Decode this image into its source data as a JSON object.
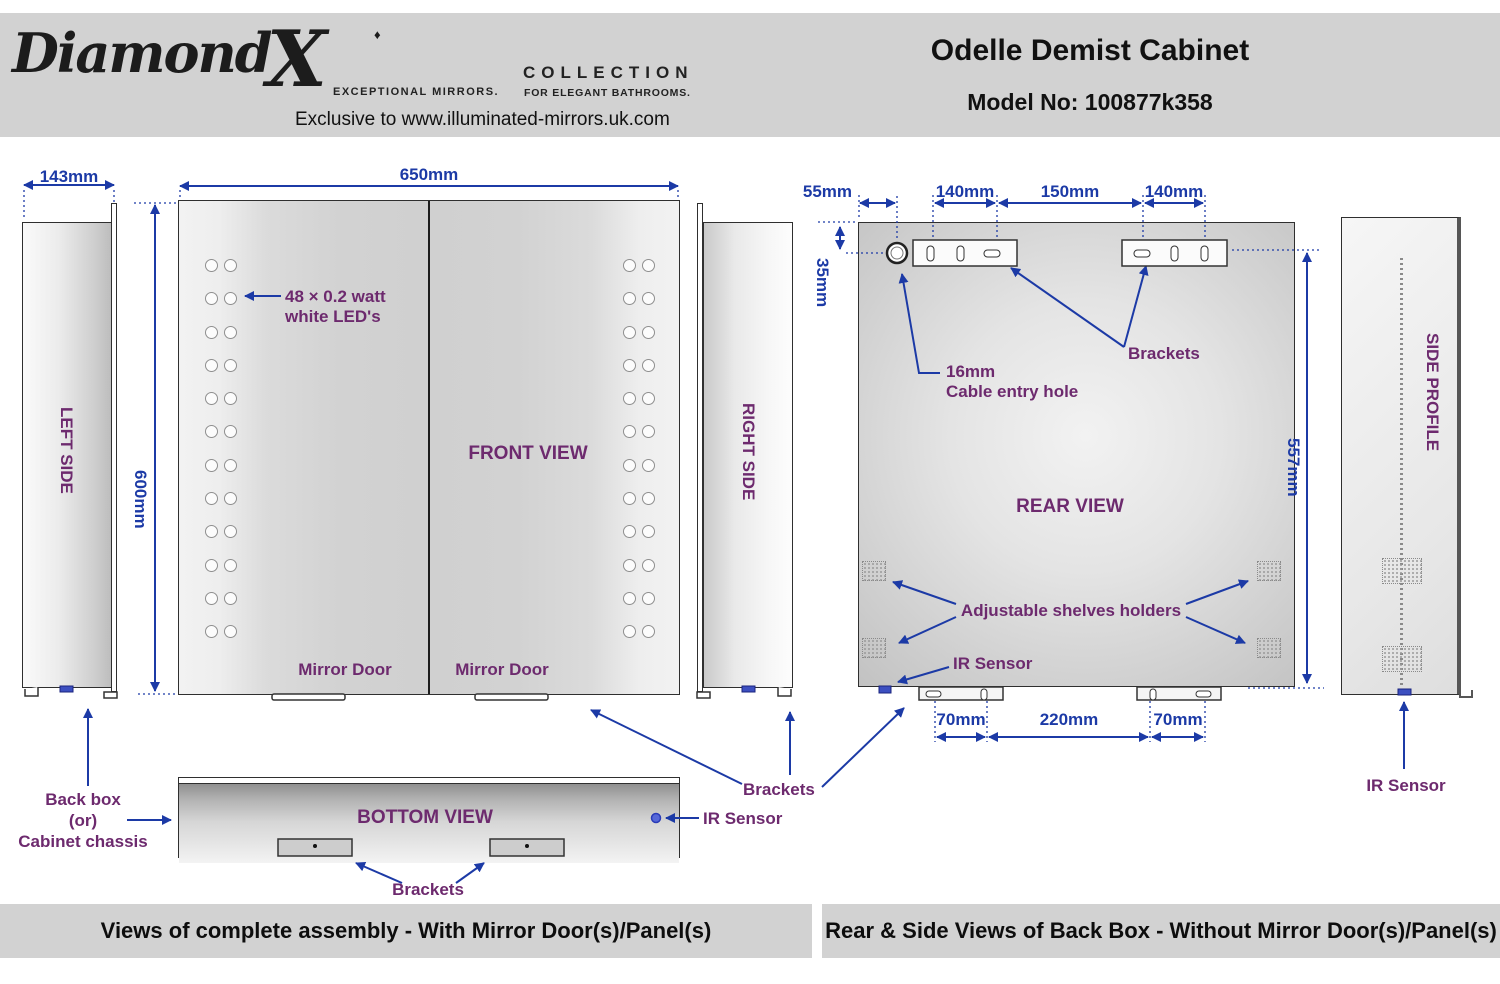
{
  "header": {
    "logo": {
      "brand_script": "Diamond",
      "brand_x": "X",
      "diamond_icon": "♦",
      "tagline_left": "EXCEPTIONAL MIRRORS.",
      "collection": "COLLECTION",
      "tagline_right": "FOR ELEGANT BATHROOMS.",
      "exclusive": "Exclusive to www.illuminated-mirrors.uk.com"
    },
    "title": "Odelle Demist Cabinet",
    "model": "Model No: 100877k358"
  },
  "dims": {
    "left_width": "143mm",
    "front_width": "650mm",
    "front_height": "600mm",
    "rear_offset": "55mm",
    "rear_b1": "140mm",
    "rear_gap": "150mm",
    "rear_b2": "140mm",
    "rear_top": "35mm",
    "rear_height": "557mm",
    "rear_bot_left": "70mm",
    "rear_bot_mid": "220mm",
    "rear_bot_right": "70mm"
  },
  "labels": {
    "left_side": "LEFT SIDE",
    "front_view": "FRONT VIEW",
    "right_side": "RIGHT SIDE",
    "rear_view": "REAR VIEW",
    "side_profile": "SIDE PROFILE",
    "bottom_view": "BOTTOM VIEW",
    "mirror_door_left": "Mirror Door",
    "mirror_door_right": "Mirror Door",
    "led_note_1": "48 × 0.2 watt",
    "led_note_2": "white LED's",
    "cable_note_1": "16mm",
    "cable_note_2": "Cable entry hole",
    "brackets_rear": "Brackets",
    "shelves": "Adjustable shelves holders",
    "ir_rear": "IR Sensor",
    "ir_side": "IR Sensor",
    "ir_bottom": "IR Sensor",
    "brackets_assembly": "Brackets",
    "brackets_bottom": "Brackets",
    "chassis_1": "Back box",
    "chassis_2": "(or)",
    "chassis_3": "Cabinet chassis"
  },
  "front": {
    "led_rows": 12
  },
  "footer": {
    "left": "Views of complete assembly - With Mirror Door(s)/Panel(s)",
    "right": "Rear & Side Views of Back Box - Without Mirror Door(s)/Panel(s)"
  },
  "colors": {
    "dimension_blue": "#1c3aa6",
    "label_purple": "#6d2a6e",
    "band_grey": "#d2d2d2"
  }
}
